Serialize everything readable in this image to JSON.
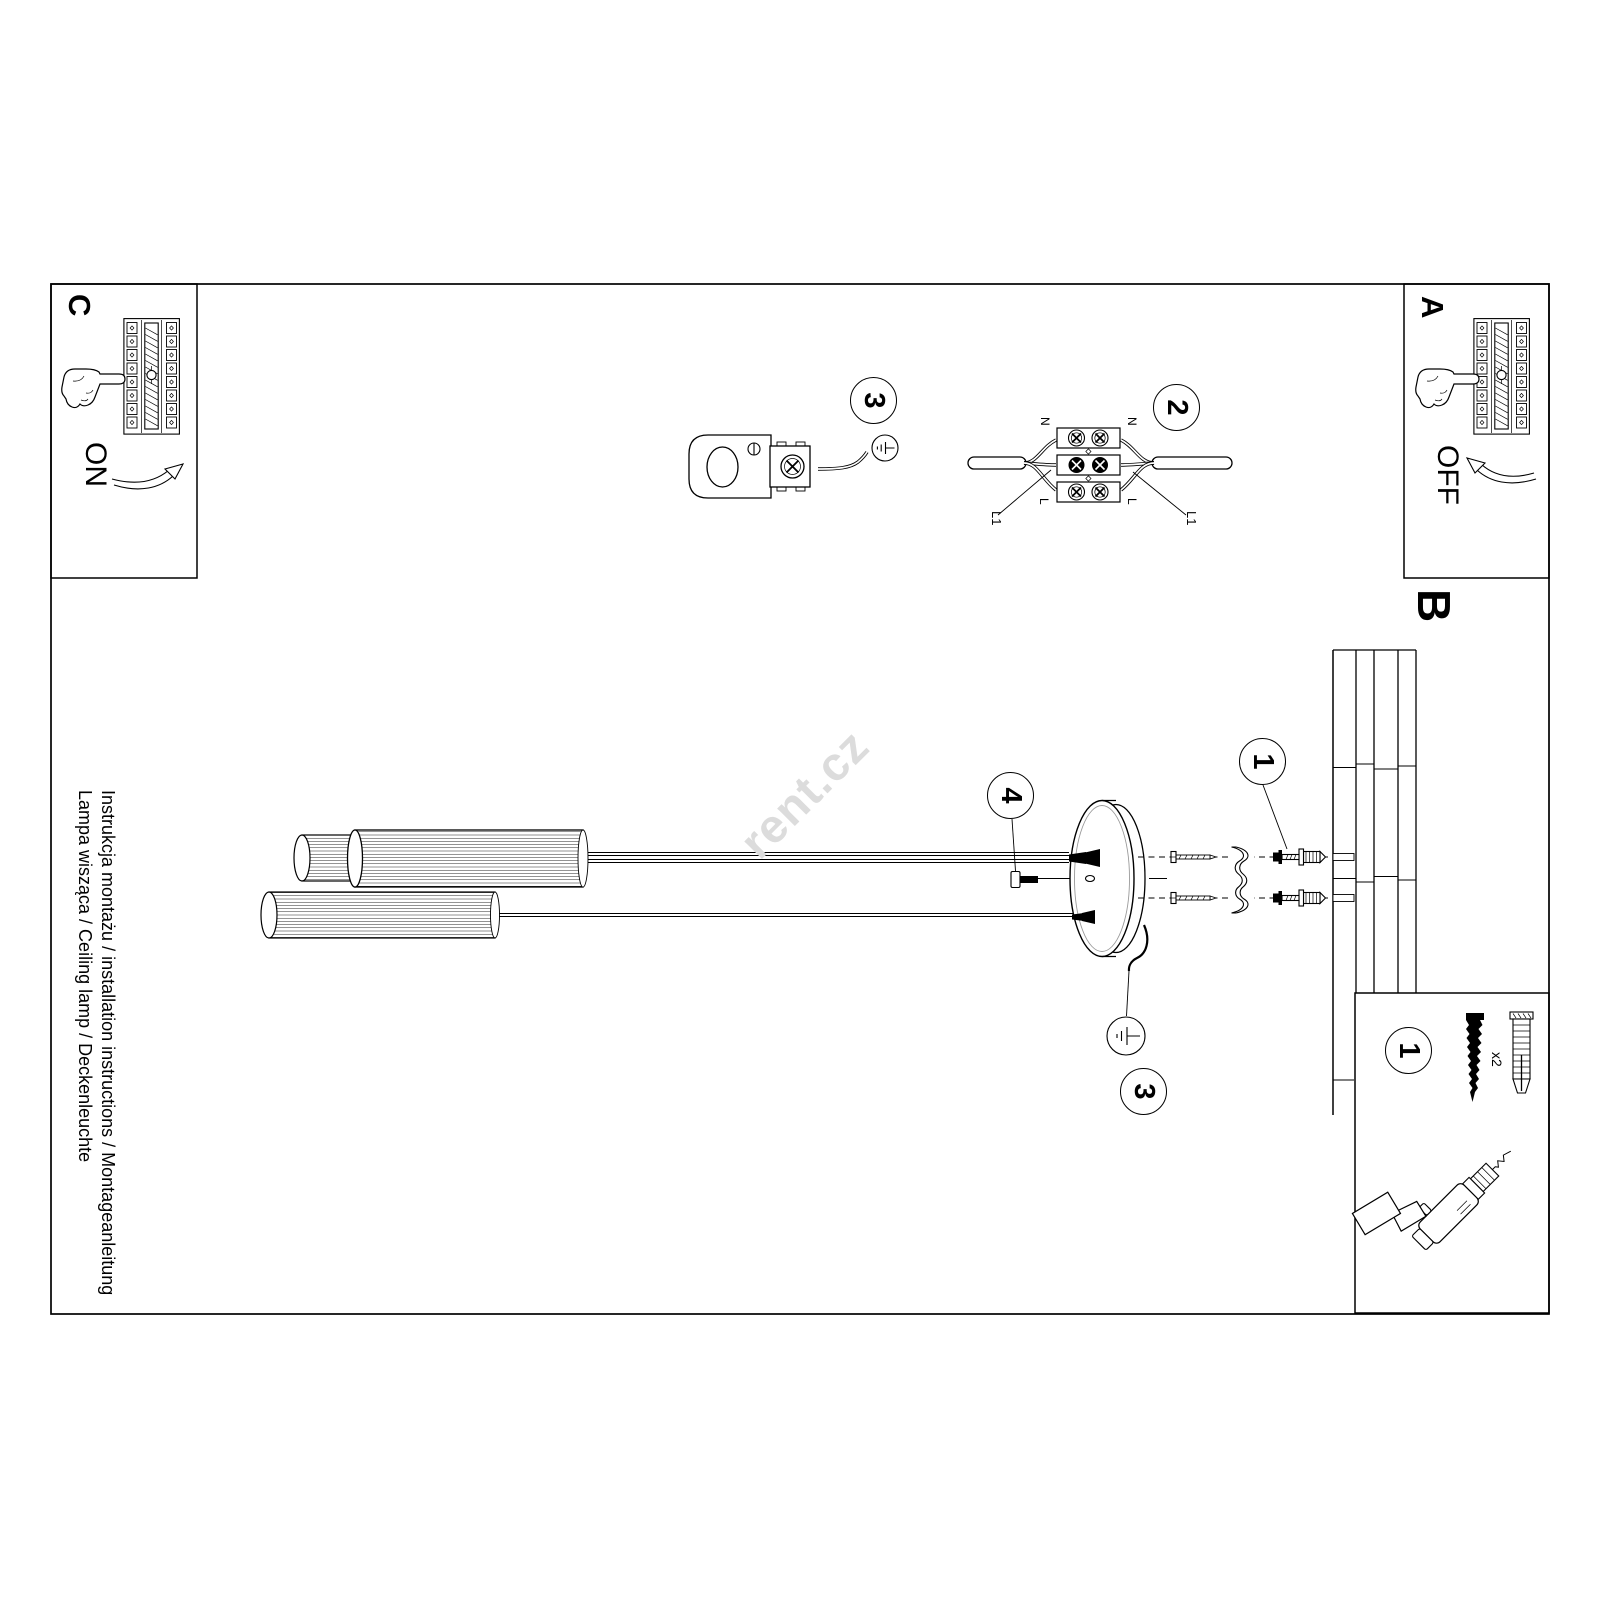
{
  "page": {
    "watermark": "rent.cz",
    "footer": {
      "line1": "Instrukcja montażu / installation instructions / Montageanleitung",
      "line2": "Lampa wisząca / Ceiling lamp / Deckenleuchte"
    },
    "sections": {
      "a": {
        "label": "A",
        "action": "OFF"
      },
      "b": {
        "label": "B"
      },
      "c": {
        "label": "C",
        "action": "ON"
      }
    },
    "steps": {
      "one": "1",
      "two": "2",
      "three": "3",
      "four": "4"
    },
    "wiring": {
      "neutral": "N",
      "live": "L",
      "switched_live": "L1"
    },
    "parts": {
      "screw_quantity": "x2"
    },
    "colors": {
      "line": "#000000",
      "paper": "#ffffff",
      "watermark": "#dcdcdc"
    },
    "icons": {
      "ground_symbol": "earth-ground symbol in circle",
      "breaker_panel": "fuse box with finger flipping breaker",
      "flip_arrow": "curved flip-direction arrow",
      "pointing_hand": "hand with extended index finger",
      "drill": "cordless drill",
      "wall_plug": "expansion wall anchor",
      "screw": "mounting screw"
    }
  }
}
